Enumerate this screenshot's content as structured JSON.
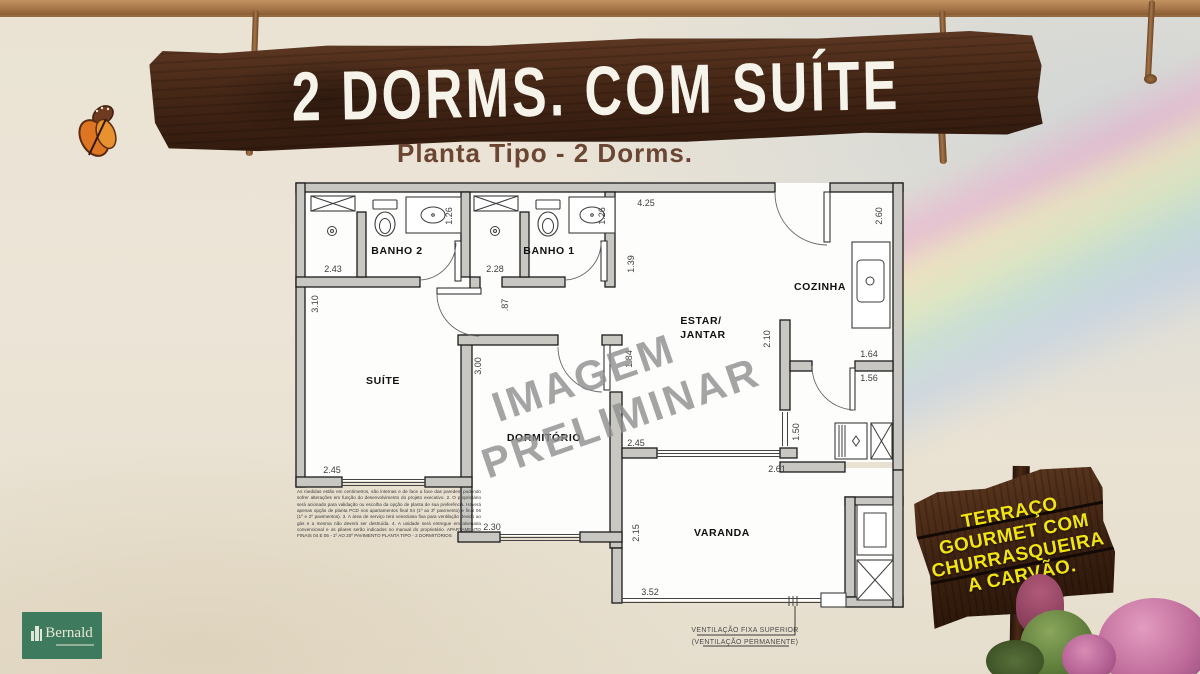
{
  "header": {
    "title": "2 DORMS. COM SUÍTE",
    "subtitle": "Planta Tipo - 2 Dorms."
  },
  "plan": {
    "rooms": {
      "banho2": "BANHO 2",
      "banho1": "BANHO 1",
      "suite": "SUÍTE",
      "dormitorio": "DORMITÓRIO",
      "estar1": "ESTAR/",
      "estar2": "JANTAR",
      "cozinha": "COZINHA",
      "varanda": "VARANDA"
    },
    "dims": {
      "banho2_w": "2.43",
      "banho2_d": "1.26",
      "banho1_w": "2.28",
      "banho1_d": "1.26",
      "estar_top": "4.25",
      "cozinha_w": "2.60",
      "estar_l": "1.39",
      "suite_l": "3.10",
      "hall": ".87",
      "suite_w": "2.45",
      "dorm_l": "3.00",
      "dorm_w": "2.30",
      "estar_dorm": "1.84",
      "cozinha_pass": "2.10",
      "serv_top": "1.64",
      "serv_mid": "1.56",
      "serv_door": "1.50",
      "estar_b": "2.45",
      "varanda_t": "2.61",
      "varanda_l": "2.15",
      "varanda_b": "3.52"
    },
    "watermark": {
      "l1": "IMAGEM",
      "l2": "PRELIMINAR"
    },
    "vent_note": {
      "l1": "VENTILAÇÃO FIXA SUPERIOR",
      "l2": "(VENTILAÇÃO PERMANENTE)"
    },
    "disclaimer": "As medidas estão em centímetros, são internas e de face a face das paredes, podendo sofrer alterações em função do desenvolvimento do projeto executivo. 2. O proprietário será acionado para validação ou escolha da opção de planta de sua preferência. Haverá apenas opção de planta PCD nos apartamentos final 04 (1º ao 3º pavimento) e final 06 (1º e 2º pavimentos). 3. A área de serviço terá veneziana fixa para ventilação devido ao gás e a mesma não deverá ser destruída. 4. A unidade será entregue em alvenaria convencional e os pilares serão indicados no manual do proprietário. APARTAMENTO FINAIS 04 E 05 - 1º AO 20º PAVIMENTO PLANTA TIPO - 2 DORMITÓRIOS"
  },
  "sign": {
    "lines": [
      "TERRAÇO",
      "GOURMET COM",
      "CHURRASQUEIRA",
      "A CARVÃO."
    ]
  },
  "logo": {
    "name": "Bernald"
  },
  "colors": {
    "sign_text": "#f1e412",
    "logo_bg": "#3e7b5e",
    "subtitle_brown": "#6b4632",
    "plank_brown": "#46281a",
    "wall_fill": "#c9c7c2"
  }
}
